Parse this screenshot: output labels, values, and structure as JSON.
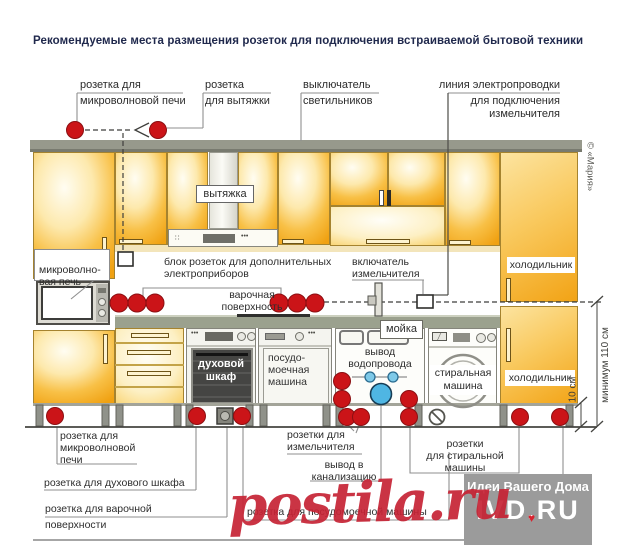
{
  "title": "Рекомендуемые места размещения розеток для подключения встраиваемой бытовой техники",
  "colors": {
    "accent_red": "#cb1418",
    "cabinet_orange": "#f2a315",
    "counter_gray": "#9ba18e",
    "water_blue": "#4fb6e3",
    "title_navy": "#20294d"
  },
  "callouts_top": {
    "microwave": {
      "l1": "розетка для",
      "l2": "микроволновой печи"
    },
    "hood": {
      "l1": "розетка",
      "l2": "для вытяжки"
    },
    "light_switch": {
      "l1": "выключатель",
      "l2": "светильников"
    },
    "grinder_line": {
      "l1": "линия электропроводки",
      "l2": "для подключения\nизмельчителя"
    }
  },
  "diagram": {
    "hood_box": "вытяжка",
    "microwave": "микроволно-\nвая печь",
    "socket_block": "блок розеток для дополнительных\nэлектроприборов",
    "cooktop": "варочная\nповерхность",
    "grinder_switch": "включатель\nизмельчителя",
    "fridge_top": "холодильник",
    "fridge_bottom": "холодильник",
    "sink": "мойка",
    "water_outlet": "вывод\nводопровода",
    "oven": "духовой\nшкаф",
    "dishwasher": "посудо-\nмоечная\nмашина",
    "washer": "стиральная\nмашина"
  },
  "callouts_bottom": {
    "microwave_socket": "розетка для\nмикроволновой\nпечи",
    "oven_socket": "розетка для духового шкафа",
    "cooktop_socket_l1": "розетка для варочной",
    "cooktop_socket_l2": "поверхности",
    "grinder_sockets": "розетки для\nизмельчителя",
    "sewer": "вывод в\nканализацию",
    "dishwasher_socket": "розетка для посудомоечной машины",
    "washer_sockets": "розетки\nдля стиральной\nмашины"
  },
  "dimensions": {
    "min110": "минимум 110 см",
    "plinth": "10 см"
  },
  "credits": {
    "maria": "© «Мария»",
    "watermark_line1": "Идеи Вашего Дома",
    "watermark_line2": "IVD.RU",
    "heart": "♥",
    "overlay": "postila.ru"
  }
}
